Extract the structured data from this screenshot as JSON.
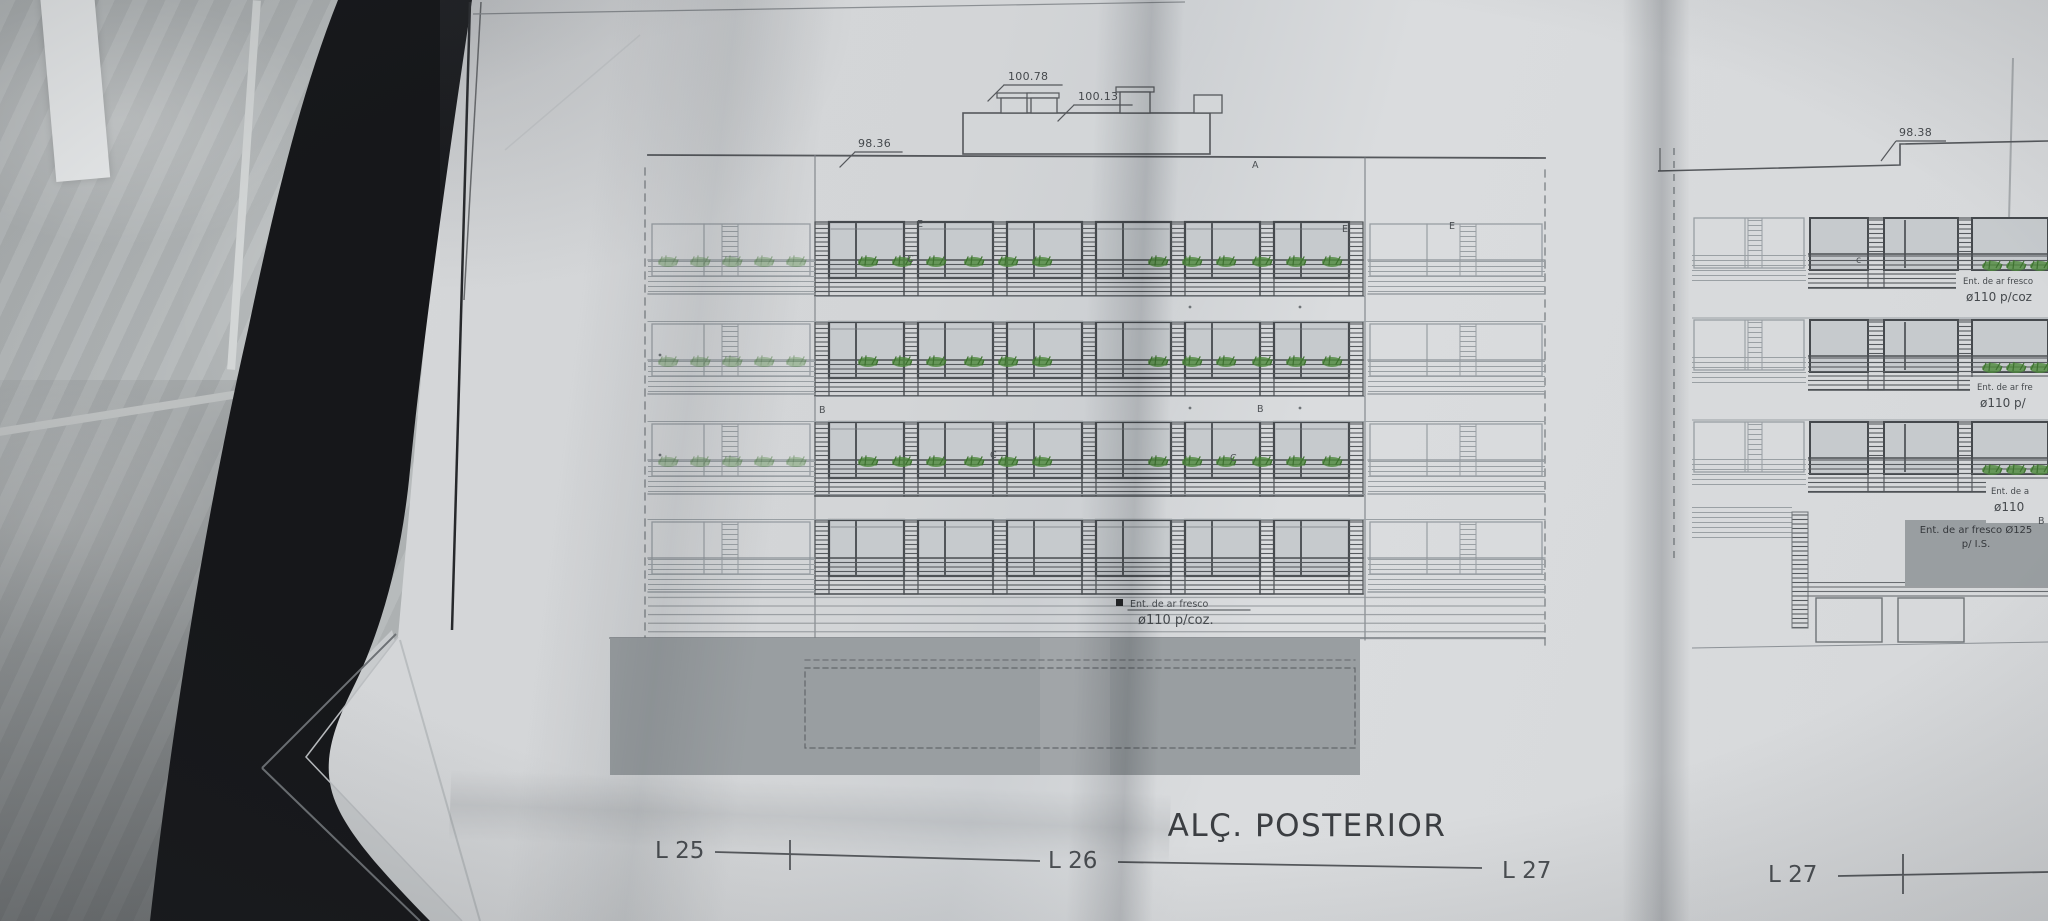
{
  "drawing": {
    "title": "ALÇ. POSTERIOR",
    "measurements": {
      "roof_high": "100.78",
      "roof_low": "100.13",
      "parapet_main": "98.36",
      "parapet_right": "98.38"
    },
    "annotation_main": {
      "line1": "Ent. de ar fresco",
      "line2": "ø110  p/coz."
    },
    "annotation_boxes": [
      {
        "line1": "Ent. de ar fresco",
        "line2": "ø110  p/coz"
      },
      {
        "line1": "Ent. de ar fre",
        "line2": "ø110  p/"
      },
      {
        "line1": "Ent. de a",
        "line2": "ø110"
      }
    ],
    "annotation_base": {
      "line1": "Ent. de ar fresco Ø125",
      "line2": "p/ I.S."
    },
    "lot_labels": {
      "l25": "L 25",
      "l26": "L 26",
      "l27a": "L 27",
      "l27b": "L 27"
    },
    "facade_letters": {
      "a1": "A",
      "e1": "E",
      "c1": "C",
      "e2": "E",
      "e3": "E",
      "b1": "B",
      "b2": "B",
      "c2": "C",
      "c3": "C",
      "c4": "c",
      "b3": "B"
    }
  }
}
